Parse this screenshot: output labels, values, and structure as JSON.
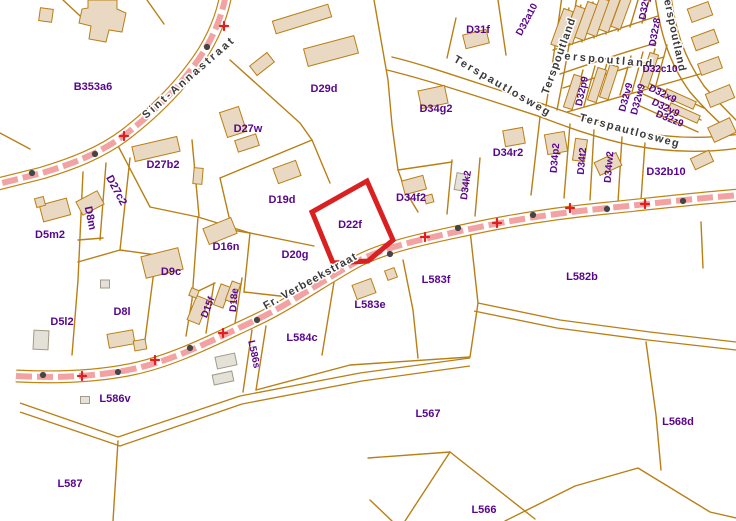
{
  "map": {
    "highlight_parcel": {
      "id": "D22f",
      "points": "367,181 393,240 368,261 333,263 312,212",
      "color": "#d92121"
    },
    "colors": {
      "parcel_line": "#b97f15",
      "building_fill": "#ead9c2",
      "shed_fill": "#e4e1d8",
      "road_fill": "#f2a2a2",
      "road_casing": "#c08514",
      "label": "#57068c",
      "street_label": "#3a3a3a",
      "highlight": "#d92121",
      "dot": "#454545",
      "cross": "#e02020"
    },
    "parcel_labels": [
      {
        "id": "B353a6",
        "x": 93,
        "y": 86,
        "rot": 0,
        "fs": 11
      },
      {
        "id": "D29d",
        "x": 324,
        "y": 88,
        "rot": 0,
        "fs": 11
      },
      {
        "id": "D27w",
        "x": 248,
        "y": 128,
        "rot": 0,
        "fs": 11
      },
      {
        "id": "D31f",
        "x": 478,
        "y": 29,
        "rot": 0,
        "fs": 11
      },
      {
        "id": "D34g2",
        "x": 436,
        "y": 108,
        "rot": 0,
        "fs": 11
      },
      {
        "id": "D34r2",
        "x": 508,
        "y": 152,
        "rot": 0,
        "fs": 11
      },
      {
        "id": "D34p2",
        "x": 554,
        "y": 158,
        "rot": -85,
        "fs": 10
      },
      {
        "id": "D34t2",
        "x": 581,
        "y": 161,
        "rot": -85,
        "fs": 10
      },
      {
        "id": "D34w2",
        "x": 608,
        "y": 167,
        "rot": -85,
        "fs": 10
      },
      {
        "id": "D34k2",
        "x": 465,
        "y": 185,
        "rot": -82,
        "fs": 10
      },
      {
        "id": "D34f2",
        "x": 411,
        "y": 197,
        "rot": 0,
        "fs": 11
      },
      {
        "id": "D32b10",
        "x": 666,
        "y": 171,
        "rot": 0,
        "fs": 11
      },
      {
        "id": "D32c10",
        "x": 660,
        "y": 68,
        "rot": 0,
        "fs": 10
      },
      {
        "id": "D32a10",
        "x": 526,
        "y": 19,
        "rot": -62,
        "fs": 10
      },
      {
        "id": "D32y8",
        "x": 644,
        "y": 5,
        "rot": -80,
        "fs": 10
      },
      {
        "id": "D32z8",
        "x": 654,
        "y": 32,
        "rot": -80,
        "fs": 10
      },
      {
        "id": "D32p9",
        "x": 581,
        "y": 91,
        "rot": -78,
        "fs": 10
      },
      {
        "id": "D32v9",
        "x": 625,
        "y": 97,
        "rot": -75,
        "fs": 10
      },
      {
        "id": "D32w9",
        "x": 637,
        "y": 99,
        "rot": -75,
        "fs": 10
      },
      {
        "id": "D32x9",
        "x": 663,
        "y": 93,
        "rot": 26,
        "fs": 10
      },
      {
        "id": "D32y9",
        "x": 666,
        "y": 107,
        "rot": 26,
        "fs": 10
      },
      {
        "id": "D32z9",
        "x": 670,
        "y": 118,
        "rot": 22,
        "fs": 10
      },
      {
        "id": "D27b2",
        "x": 163,
        "y": 164,
        "rot": 0,
        "fs": 11
      },
      {
        "id": "D27c2",
        "x": 117,
        "y": 190,
        "rot": 62,
        "fs": 11
      },
      {
        "id": "D8m",
        "x": 91,
        "y": 218,
        "rot": 78,
        "fs": 11
      },
      {
        "id": "D5m2",
        "x": 50,
        "y": 234,
        "rot": 0,
        "fs": 11
      },
      {
        "id": "D16n",
        "x": 226,
        "y": 246,
        "rot": 0,
        "fs": 11
      },
      {
        "id": "D9c",
        "x": 171,
        "y": 271,
        "rot": 0,
        "fs": 11
      },
      {
        "id": "D19d",
        "x": 282,
        "y": 199,
        "rot": 0,
        "fs": 11
      },
      {
        "id": "D22f",
        "x": 350,
        "y": 224,
        "rot": 0,
        "fs": 11
      },
      {
        "id": "D20g",
        "x": 295,
        "y": 254,
        "rot": 0,
        "fs": 11
      },
      {
        "id": "D5l2",
        "x": 62,
        "y": 321,
        "rot": 0,
        "fs": 11
      },
      {
        "id": "D8l",
        "x": 122,
        "y": 311,
        "rot": 0,
        "fs": 11
      },
      {
        "id": "D15f",
        "x": 207,
        "y": 307,
        "rot": -68,
        "fs": 10
      },
      {
        "id": "D18e",
        "x": 233,
        "y": 300,
        "rot": -85,
        "fs": 10
      },
      {
        "id": "L586s",
        "x": 255,
        "y": 354,
        "rot": 78,
        "fs": 10
      },
      {
        "id": "L583e",
        "x": 370,
        "y": 304,
        "rot": 0,
        "fs": 11
      },
      {
        "id": "L583f",
        "x": 436,
        "y": 279,
        "rot": 0,
        "fs": 11
      },
      {
        "id": "L584c",
        "x": 302,
        "y": 337,
        "rot": 0,
        "fs": 11
      },
      {
        "id": "L582b",
        "x": 582,
        "y": 276,
        "rot": 0,
        "fs": 11
      },
      {
        "id": "L586v",
        "x": 115,
        "y": 398,
        "rot": 0,
        "fs": 11
      },
      {
        "id": "L567",
        "x": 428,
        "y": 413,
        "rot": 0,
        "fs": 11
      },
      {
        "id": "L568d",
        "x": 678,
        "y": 421,
        "rot": 0,
        "fs": 11
      },
      {
        "id": "L587",
        "x": 70,
        "y": 483,
        "rot": 0,
        "fs": 11
      },
      {
        "id": "L566",
        "x": 484,
        "y": 509,
        "rot": 0,
        "fs": 11
      }
    ],
    "street_labels": [
      {
        "name": "Sint-Annastraat",
        "x": 191,
        "y": 80,
        "rot": -41,
        "ls": 2.5
      },
      {
        "name": "Fr. Verbeekstraat",
        "x": 312,
        "y": 284,
        "rot": -29,
        "ls": 1
      },
      {
        "name": "Terspautlosweg",
        "x": 501,
        "y": 89,
        "rot": 30,
        "ls": 2
      },
      {
        "name": "Terspautlosweg",
        "x": 629,
        "y": 134,
        "rot": 15,
        "ls": 1.5
      },
      {
        "name": "Terspoutland",
        "x": 605,
        "y": 63,
        "rot": 5,
        "ls": 2.5
      },
      {
        "name": "Terspoutland",
        "x": 562,
        "y": 57,
        "rot": -70,
        "ls": 1
      },
      {
        "name": "Terspoutland",
        "x": 671,
        "y": 33,
        "rot": 78,
        "ls": 1
      }
    ],
    "roads": [
      {
        "name": "road-sint-annastraat",
        "d": "M226,-6 C221,22 209,46 193,67 C176,90 153,113 126,134 C101,153 72,164 42,173 L-2,184",
        "dots": [
          [
            207,
            47
          ],
          [
            95,
            154
          ],
          [
            32,
            173
          ]
        ],
        "crosses": [
          [
            224,
            26
          ],
          [
            124,
            136
          ]
        ]
      },
      {
        "name": "road-fr-verbeekstraat",
        "d": "M16,376 C55,378 95,377 133,369 C175,360 213,340 256,320 C288,305 322,281 356,262 C386,246 428,238 470,229 C512,220 556,213 608,208 C648,204 700,198 740,195",
        "dots": [
          [
            43,
            375
          ],
          [
            118,
            372
          ],
          [
            190,
            348
          ],
          [
            257,
            320
          ],
          [
            390,
            254
          ],
          [
            458,
            228
          ],
          [
            533,
            215
          ],
          [
            607,
            209
          ],
          [
            683,
            201
          ]
        ],
        "crosses": [
          [
            82,
            376
          ],
          [
            155,
            360
          ],
          [
            223,
            333
          ],
          [
            425,
            237
          ],
          [
            497,
            223
          ],
          [
            570,
            208
          ],
          [
            645,
            204
          ]
        ]
      }
    ],
    "boundaries": [
      "M63,0 L93,28",
      "M147,0 L164,24",
      "M0,133 L30,149",
      "M230,60 L300,123 L312,140 L330,183",
      "M312,140 L220,178",
      "M220,178 L232,230 L250,233",
      "M374,0 L388,80 L392,125 L398,170 L406,192 L418,212",
      "M398,170 L452,162",
      "M250,233 L314,246",
      "M250,233 L244,292",
      "M198,217 L250,233",
      "M198,217 L192,300",
      "M244,292 L298,298",
      "M192,300 L186,336",
      "M190,295 L215,283",
      "M214,283 L206,333",
      "M242,278 L234,330",
      "M115,140 L150,207 L198,217",
      "M192,140 L199,216",
      "M106,163 L100,240",
      "M83,172 L78,280 L72,355",
      "M78,240 L103,238",
      "M130,158 L120,250",
      "M78,262 L120,250 L156,255",
      "M156,255 L145,340",
      "M456,18 L447,58",
      "M498,0 L506,55",
      "M540,117 L531,195",
      "M570,124 L564,198",
      "M594,130 L590,200",
      "M622,137 L618,202",
      "M645,143 L641,200",
      "M452,160 L447,214",
      "M480,158 L475,216",
      "M553,50 L658,16",
      "M567,112 L700,74",
      "M558,49 L569,8",
      "M570,45 L581,5",
      "M582,42 L593,2",
      "M594,38 L605,-2",
      "M606,34 L617,-5",
      "M618,31 L629,-8",
      "M630,27 L641,-10",
      "M642,23 L653,-12",
      "M572,109 L583,70",
      "M584,106 L595,66",
      "M596,102 L607,63",
      "M608,99 L619,59",
      "M620,95 L631,56",
      "M632,92 L643,52",
      "M644,88 L655,49",
      "M656,85 L667,45",
      "M646,82 L704,108",
      "M643,94 L701,120",
      "M640,106 L698,132",
      "M392,57 C430,66 490,88 543,104",
      "M387,70 C428,80 486,99 538,116",
      "M543,104 C600,124 660,146 740,134",
      "M538,116 C596,138 656,160 740,148",
      "M562,-4 C556,40 551,75 546,106",
      "M577,-4 C570,42 563,80 557,110",
      "M560,74 C595,62 625,52 656,43",
      "M563,88 C600,76 632,66 664,57",
      "M655,-4 C660,30 668,62 690,92",
      "M671,-4 C675,28 683,56 704,86",
      "M690,92 C702,106 716,120 730,132",
      "M704,86 C716,100 728,112 740,124",
      "M252,330 L243,392",
      "M266,326 L256,390",
      "M334,282 L322,355",
      "M403,260 L413,310 L418,358",
      "M470,230 L478,303",
      "M256,390 L350,365 L470,357",
      "M470,357 L478,303",
      "M646,342 L656,415 L661,470",
      "M701,222 L703,268",
      "M118,441 L113,521",
      "M368,458 L450,452 L535,519",
      "M450,452 L405,521",
      "M370,500 L392,521",
      "M505,521 L575,486 L638,468 L710,512 L736,518"
    ],
    "tracks": [
      "M20,403 L118,437 L240,396 L360,373 L470,358",
      "M20,412 L120,446 L242,404 L362,381 L470,366",
      "M478,303 L560,320 L650,332 L736,342",
      "M474,311 L557,328 L648,340 L736,350"
    ],
    "building_polys": [
      "88,0 117,0 117,9 126,13 122,32 109,30 106,42 89,39 91,26 79,23 82,9 88,8"
    ],
    "buildings": [
      [
        46,
        15,
        13,
        13,
        8,
        0
      ],
      [
        302,
        19,
        58,
        13,
        -17,
        0
      ],
      [
        331,
        51,
        52,
        18,
        -15,
        0
      ],
      [
        262,
        64,
        22,
        12,
        -38,
        0
      ],
      [
        233,
        122,
        20,
        26,
        -18,
        0
      ],
      [
        247,
        143,
        22,
        12,
        -18,
        0
      ],
      [
        287,
        172,
        24,
        16,
        -20,
        0
      ],
      [
        156,
        149,
        46,
        15,
        -13,
        0
      ],
      [
        198,
        176,
        9,
        16,
        5,
        0
      ],
      [
        90,
        203,
        24,
        15,
        -28,
        0
      ],
      [
        55,
        210,
        28,
        17,
        -15,
        0
      ],
      [
        40,
        202,
        9,
        9,
        -15,
        0
      ],
      [
        162,
        263,
        38,
        22,
        -14,
        0
      ],
      [
        220,
        231,
        30,
        17,
        -22,
        0
      ],
      [
        105,
        284,
        9,
        8,
        0,
        1
      ],
      [
        121,
        339,
        26,
        14,
        -10,
        0
      ],
      [
        140,
        345,
        12,
        10,
        -10,
        0
      ],
      [
        41,
        340,
        15,
        19,
        3,
        1
      ],
      [
        198,
        310,
        13,
        26,
        22,
        0
      ],
      [
        194,
        293,
        8,
        8,
        22,
        0
      ],
      [
        222,
        296,
        10,
        22,
        20,
        0
      ],
      [
        233,
        292,
        9,
        20,
        20,
        0
      ],
      [
        226,
        361,
        20,
        12,
        -12,
        1
      ],
      [
        223,
        378,
        20,
        10,
        -12,
        1
      ],
      [
        85,
        400,
        9,
        7,
        0,
        1
      ],
      [
        364,
        289,
        20,
        15,
        -20,
        0
      ],
      [
        391,
        274,
        10,
        10,
        -20,
        0
      ],
      [
        414,
        185,
        22,
        14,
        -15,
        0
      ],
      [
        429,
        199,
        8,
        8,
        -15,
        0
      ],
      [
        433,
        97,
        27,
        18,
        -12,
        0
      ],
      [
        476,
        39,
        24,
        14,
        -14,
        0
      ],
      [
        514,
        137,
        20,
        16,
        -10,
        0
      ],
      [
        556,
        143,
        20,
        20,
        -10,
        0
      ],
      [
        580,
        150,
        12,
        22,
        8,
        0
      ],
      [
        608,
        164,
        24,
        14,
        -25,
        0
      ],
      [
        461,
        182,
        11,
        17,
        10,
        1
      ],
      [
        700,
        12,
        22,
        14,
        -20,
        0
      ],
      [
        705,
        40,
        24,
        14,
        -20,
        0
      ],
      [
        710,
        66,
        22,
        12,
        -20,
        0
      ],
      [
        720,
        96,
        26,
        14,
        -22,
        0
      ],
      [
        722,
        130,
        24,
        16,
        -25,
        0
      ],
      [
        702,
        160,
        20,
        12,
        -25,
        0
      ],
      [
        562,
        28,
        10,
        38,
        20,
        0
      ],
      [
        574,
        25,
        10,
        38,
        20,
        0
      ],
      [
        586,
        21,
        10,
        38,
        20,
        0
      ],
      [
        598,
        17,
        10,
        38,
        20,
        0
      ],
      [
        610,
        13,
        10,
        38,
        20,
        0
      ],
      [
        622,
        10,
        10,
        38,
        20,
        0
      ],
      [
        573,
        92,
        9,
        34,
        18,
        0
      ],
      [
        597,
        85,
        9,
        34,
        18,
        0
      ],
      [
        609,
        82,
        9,
        34,
        18,
        0
      ],
      [
        649,
        70,
        9,
        34,
        18,
        0
      ],
      [
        680,
        99,
        32,
        8,
        24,
        0
      ],
      [
        684,
        113,
        32,
        8,
        24,
        0
      ]
    ]
  }
}
